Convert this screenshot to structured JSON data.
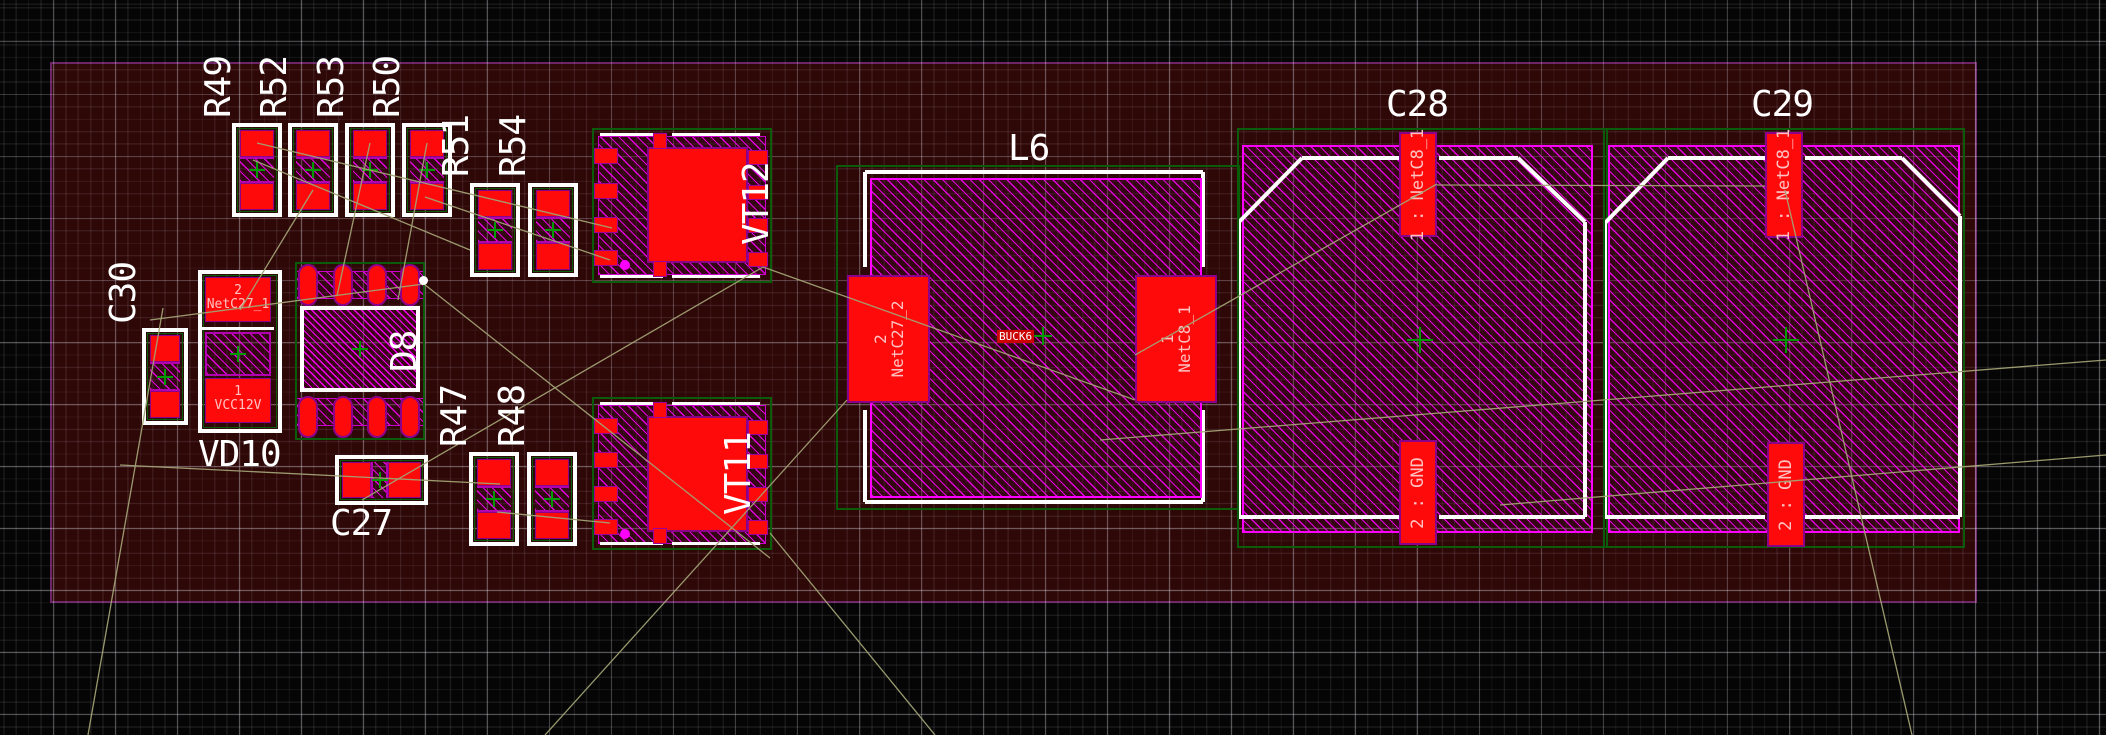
{
  "view": {
    "type": "pcb-layout-editor-canvas"
  },
  "board": {
    "color": "#2e0707",
    "edge_color": "#6e2468"
  },
  "colors": {
    "pad": "#ff0a0a",
    "pad_outline": "#8b008b",
    "hatch": "#ff00ff",
    "silkscreen": "#ffffff",
    "courtyard": "#0a5c0a",
    "ratsnest": "#a2a275",
    "pad_text": "#ffc2c2",
    "origin_cross": "#009900",
    "background": "#050505"
  },
  "refs": {
    "R49": "R49",
    "R52": "R52",
    "R53": "R53",
    "R50": "R50",
    "R51": "R51",
    "R54": "R54",
    "R47": "R47",
    "R48": "R48",
    "C30": "C30",
    "VD10": "VD10",
    "D8": "D8",
    "C27": "C27",
    "VT12": "VT12",
    "VT11": "VT11",
    "L6": "L6",
    "C28": "C28",
    "C29": "C29"
  },
  "pads": {
    "vd10_2_num": "2",
    "vd10_2_net": "NetC27_1",
    "vd10_1_num": "1",
    "vd10_1_net": "VCC12V",
    "l6_2_num": "2",
    "l6_2_net": "NetC27_2",
    "l6_1_num": "1",
    "l6_1_net": "NetC8_1",
    "c28_1": "1 : NetC8_1",
    "c28_2": "2 : GND",
    "c29_1": "1 : NetC8_1",
    "c29_2": "2 : GND"
  },
  "net_label": {
    "text": "BUCK6"
  }
}
